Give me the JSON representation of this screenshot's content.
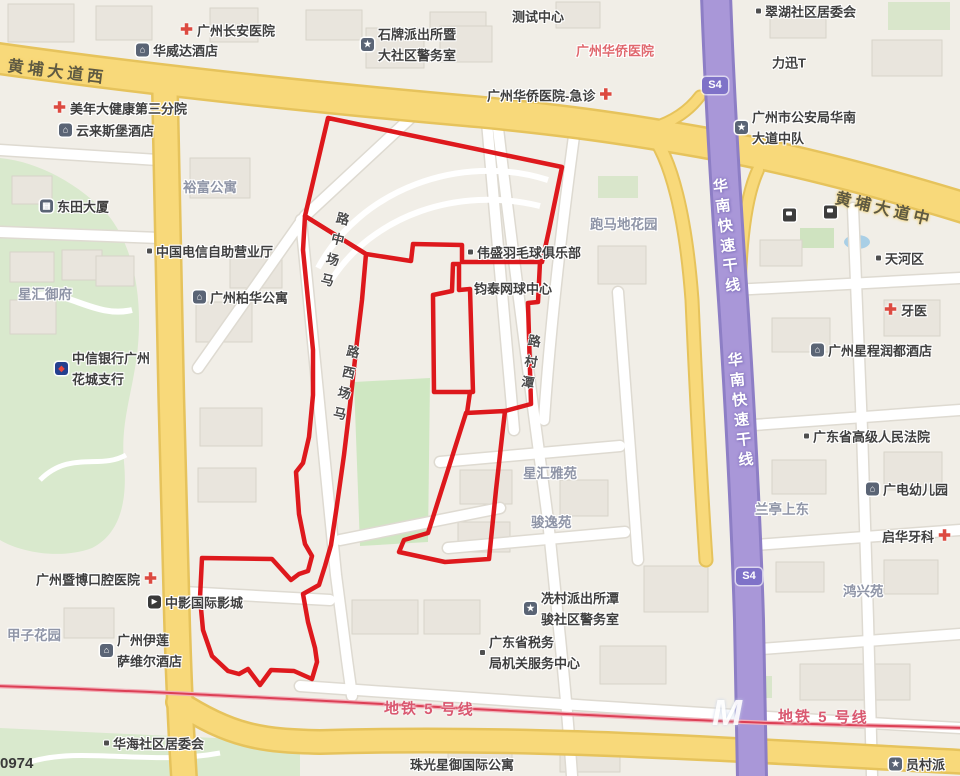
{
  "watermark": "0974",
  "colors": {
    "boundary_red": "#dc0d12",
    "road_yellow": "#f8d97a",
    "expressway_purple": "#a997d8",
    "metro_red": "#dc3f55",
    "area_label": "#8f95a7",
    "poi_text": "#3f3f3f",
    "hospital_red_text": "#e0686e"
  },
  "metro_line_name": "地铁 5 号线",
  "metro_logo": {
    "text": "M",
    "x": 712,
    "y": 692
  },
  "badges": [
    {
      "label": "S4",
      "x": 702,
      "y": 77
    },
    {
      "label": "S4",
      "x": 736,
      "y": 568
    }
  ],
  "road_labels": [
    {
      "text": "黄埔大道西",
      "x": 8,
      "y": 52,
      "rot": 7
    },
    {
      "text": "黄埔大道中",
      "x": 836,
      "y": 184,
      "rot": 13
    }
  ],
  "metro_labels": [
    {
      "text": "地铁 5 号线",
      "x": 384,
      "y": 698,
      "rot": 1
    },
    {
      "text": "地铁 5 号线",
      "x": 778,
      "y": 706,
      "rot": 1
    }
  ],
  "expressway_labels": [
    {
      "text": "华南快速干线",
      "x": 708,
      "y": 178,
      "rot": -7
    },
    {
      "text": "华南快速干线",
      "x": 723,
      "y": 352,
      "rot": -6
    }
  ],
  "street_labels": [
    {
      "name": "马场中路",
      "x": 334,
      "y": 212,
      "rot": 14
    },
    {
      "name": "马场西路",
      "x": 344,
      "y": 345,
      "rot": 12
    },
    {
      "name": "潭村路",
      "x": 525,
      "y": 334,
      "rot": 9
    }
  ],
  "pois": [
    {
      "icon": "hospital",
      "text": "广州长安医院",
      "x": 180,
      "y": 30
    },
    {
      "icon": "hotel",
      "text": "华威达酒店",
      "x": 136,
      "y": 50
    },
    {
      "icon": "hospital",
      "icon_side": "right",
      "text": "广州华侨医院-急诊",
      "x": 487,
      "y": 95
    },
    {
      "icon": "hospital",
      "text": "美年大健康第三分院",
      "x": 53,
      "y": 108
    },
    {
      "icon": "hotel",
      "text": "云来斯堡酒店",
      "x": 59,
      "y": 130
    },
    {
      "icon": "police",
      "lines": [
        "石牌派出所暨",
        "大社区警务室"
      ],
      "x": 361,
      "y": 44
    },
    {
      "text": "测试中心",
      "x": 512,
      "y": 16
    },
    {
      "text": "广州华侨医院",
      "x": 576,
      "y": 50,
      "style": "red"
    },
    {
      "icon": "dot",
      "text": "翠湖社区居委会",
      "x": 756,
      "y": 11
    },
    {
      "text": "力迅T",
      "x": 772,
      "y": 62
    },
    {
      "icon": "police",
      "lines": [
        "广州市公安局华南",
        "大道中队"
      ],
      "x": 735,
      "y": 127
    },
    {
      "icon": "building",
      "text": "东田大厦",
      "x": 40,
      "y": 206
    },
    {
      "text": "裕富公寓",
      "x": 183,
      "y": 186,
      "style": "area"
    },
    {
      "icon": "dot",
      "text": "中国电信自助营业厅",
      "x": 147,
      "y": 251
    },
    {
      "text": "星汇御府",
      "x": 18,
      "y": 293,
      "style": "area"
    },
    {
      "icon": "hotel",
      "text": "广州柏华公寓",
      "x": 193,
      "y": 297
    },
    {
      "icon": "bank",
      "lines": [
        "中信银行广州",
        "花城支行"
      ],
      "x": 55,
      "y": 368
    },
    {
      "icon": "dot",
      "text": "伟盛羽毛球俱乐部",
      "x": 468,
      "y": 252
    },
    {
      "text": "钧泰网球中心",
      "x": 474,
      "y": 288
    },
    {
      "text": "跑马地花园",
      "x": 590,
      "y": 223,
      "style": "area"
    },
    {
      "icon": "dot",
      "text": "天河区",
      "x": 876,
      "y": 258
    },
    {
      "icon": "hospital",
      "text": "牙医",
      "x": 884,
      "y": 310
    },
    {
      "icon": "hotel",
      "text": "广州星程润都酒店",
      "x": 811,
      "y": 350
    },
    {
      "icon": "dot",
      "text": "广东省高级人民法院",
      "x": 804,
      "y": 436
    },
    {
      "icon": "school",
      "text": "广电幼儿园",
      "x": 866,
      "y": 489
    },
    {
      "text": "兰亭上东",
      "x": 755,
      "y": 508,
      "style": "area"
    },
    {
      "icon": "hospital",
      "icon_side": "right",
      "text": "启华牙科",
      "x": 882,
      "y": 536
    },
    {
      "text": "鸿兴苑",
      "x": 843,
      "y": 590,
      "style": "area"
    },
    {
      "text": "星汇雅苑",
      "x": 523,
      "y": 472,
      "style": "area"
    },
    {
      "text": "骏逸苑",
      "x": 531,
      "y": 521,
      "style": "area"
    },
    {
      "icon": "police",
      "lines": [
        "冼村派出所潭",
        "骏社区警务室"
      ],
      "x": 524,
      "y": 608
    },
    {
      "icon": "dot",
      "lines": [
        "广东省税务",
        "局机关服务中心"
      ],
      "x": 480,
      "y": 652
    },
    {
      "icon": "hospital",
      "icon_side": "right",
      "text": "广州暨博口腔医院",
      "x": 36,
      "y": 579
    },
    {
      "icon": "cinema",
      "text": "中影国际影城",
      "x": 148,
      "y": 602
    },
    {
      "text": "甲子花园",
      "x": 7,
      "y": 634,
      "style": "area"
    },
    {
      "icon": "hotel",
      "lines": [
        "广州伊莲",
        "萨维尔酒店"
      ],
      "x": 100,
      "y": 650
    },
    {
      "icon": "dot",
      "text": "华海社区居委会",
      "x": 104,
      "y": 743
    },
    {
      "text": "珠光星御国际公寓",
      "x": 410,
      "y": 764
    },
    {
      "icon": "police",
      "text": "员村派",
      "x": 889,
      "y": 764
    },
    {
      "icon": "gas",
      "text": "",
      "x": 783,
      "y": 215
    },
    {
      "icon": "gas",
      "text": "",
      "x": 824,
      "y": 212
    }
  ]
}
